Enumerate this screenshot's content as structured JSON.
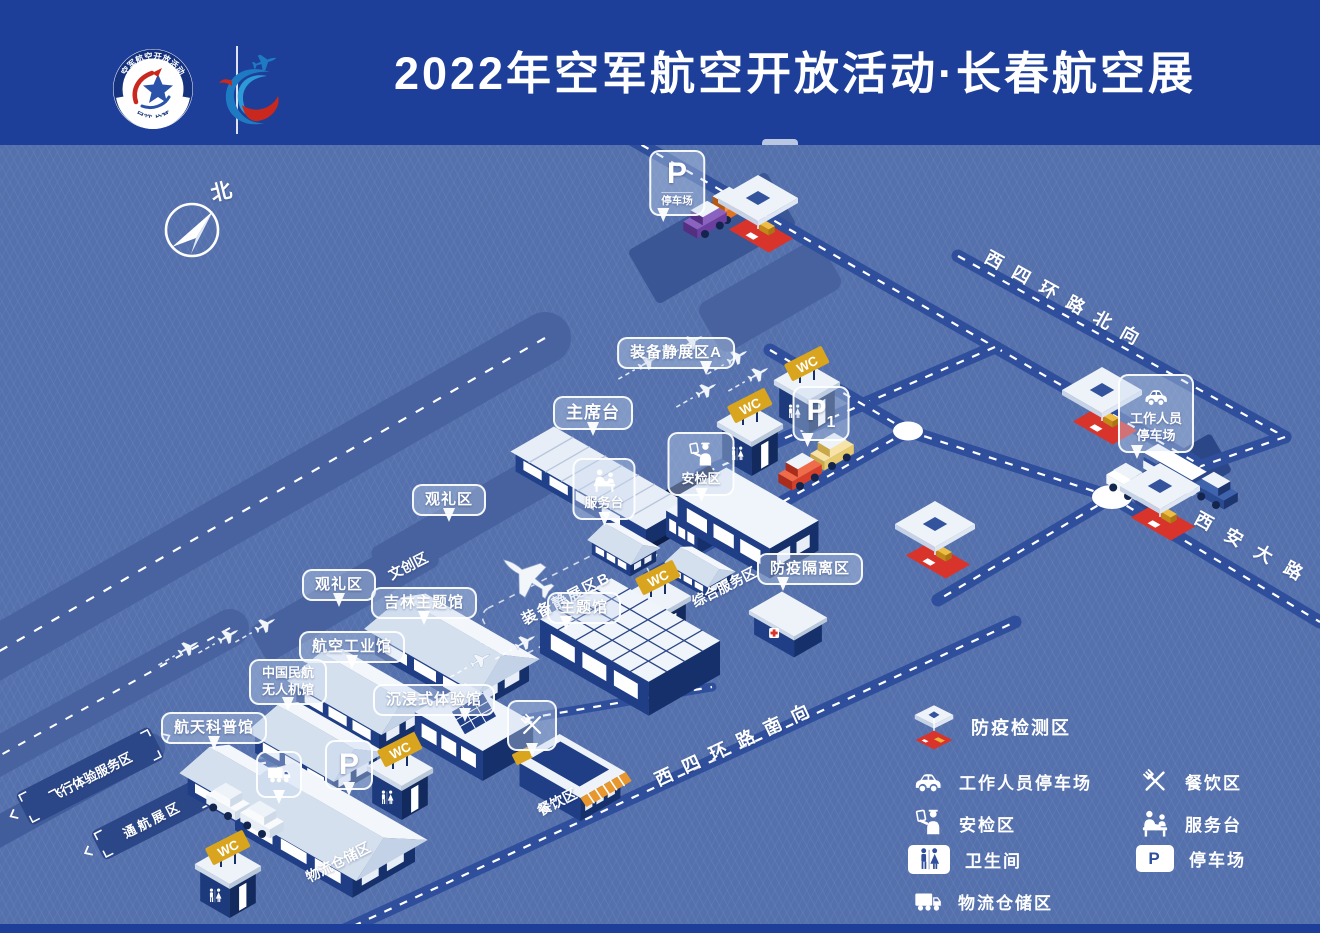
{
  "colors": {
    "header_bg": "#1e3f99",
    "map_bg": "#5571ad",
    "road": "#2f4f9c",
    "gold": "#d9a51f",
    "red": "#d8342c",
    "dark_panel": "#2c4787"
  },
  "header": {
    "title": "2022年空军航空开放活动·长春航空展",
    "badge_top_text": "空军航空开放活动",
    "badge_bottom_text": "吉林·长春"
  },
  "map": {
    "compass": "北",
    "roads": {
      "north_ring": "西四环路北向",
      "south_ring": "西四环路南向",
      "xian_avenue": "西安大路"
    },
    "balloons": {
      "parking_top_letter": "P",
      "parking_top_label": "停车场",
      "equipment_a": "装备静展区A",
      "rostrum": "主席台",
      "viewing_1": "观礼区",
      "viewing_2": "观礼区",
      "jilin_hall": "吉林主题馆",
      "theme_hall": "主题馆",
      "aviation_industry_hall": "航空工业馆",
      "caac_uav_hall_line1": "中国民航",
      "caac_uav_hall_line2": "无人机馆",
      "aerospace_hall": "航天科普馆",
      "immersive_hall": "沉浸式体验馆",
      "security_check": "安检区",
      "service_desk": "服务台",
      "quarantine": "防疫隔离区",
      "staff_parking_line1": "工作人员",
      "staff_parking_line2": "停车场",
      "p1_letter": "P",
      "p1_sub": "1",
      "p_south": "P"
    },
    "ground": {
      "cultural_creative": "文创区",
      "equipment_b": "装备静展区B",
      "comprehensive_service": "综合服务区",
      "logistics": "物流仓储区",
      "dining": "餐饮区",
      "flight_experience": "飞行体验服务区",
      "general_aviation": "通航展区"
    },
    "signs": {
      "wc": "WC"
    }
  },
  "legend": {
    "featured": {
      "icon": "tent-icon",
      "label": "防疫检测区"
    },
    "parking_letter": "P",
    "col1": [
      {
        "icon": "car-icon",
        "label": "工作人员停车场"
      },
      {
        "icon": "security-check-icon",
        "label": "安检区"
      },
      {
        "icon": "restroom-icon",
        "label": "卫生间"
      },
      {
        "icon": "truck-icon",
        "label": "物流仓储区"
      }
    ],
    "col2": [
      {
        "icon": "dining-icon",
        "label": "餐饮区"
      },
      {
        "icon": "service-desk-icon",
        "label": "服务台"
      },
      {
        "icon": "parking-icon",
        "label": "停车场"
      }
    ]
  }
}
